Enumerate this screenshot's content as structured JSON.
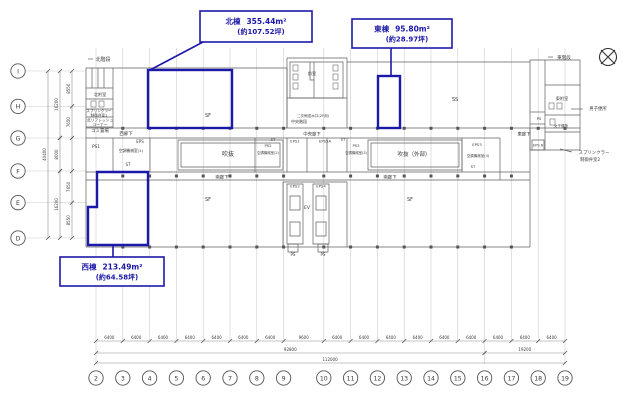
{
  "drawing_type": "architectural-floor-plan",
  "colors": {
    "highlight_blue": "#1c19a8",
    "wall_gray": "#5f5f5f",
    "grid_gray": "#c9c9c9"
  },
  "boxes": {
    "north": {
      "label": "北棟",
      "area": "355.44m²",
      "tsubo": "(約107.52坪)"
    },
    "east": {
      "label": "東棟",
      "area": "95.80m²",
      "tsubo": "(約28.97坪)"
    },
    "west": {
      "label": "西棟",
      "area": "213.49m²",
      "tsubo": "(約64.58坪)"
    }
  },
  "grid": {
    "cols": [
      "2",
      "3",
      "4",
      "5",
      "6",
      "7",
      "8",
      "9",
      "10",
      "11",
      "12",
      "13",
      "14",
      "15",
      "16",
      "17",
      "18",
      "19"
    ],
    "col_dims": [
      "6400",
      "6400",
      "6400",
      "6400",
      "6400",
      "6400",
      "6400",
      "9600",
      "6400",
      "6400",
      "6400",
      "6400",
      "6400",
      "6400",
      "6400",
      "6400",
      "6400"
    ],
    "col_span_dims": [
      {
        "label": "92800",
        "from": 0,
        "to": 14
      },
      {
        "label": "19200",
        "from": 14,
        "to": 17
      }
    ],
    "col_total": "112000",
    "rows": [
      "I",
      "H",
      "G",
      "F",
      "E",
      "D"
    ],
    "row_dims": [
      "8550",
      "7650",
      "8000",
      "7650",
      "8550"
    ],
    "row_span_dims": [
      "16200",
      "8000",
      "16200"
    ],
    "row_total": "40400"
  },
  "rooms": {
    "north_stair": "北階段",
    "north_annex": "北附室",
    "sprinkler1_l1": "スプリンクラー",
    "sprinkler1_l2": "制御弁室1",
    "refresh_l1": "北リフレッシュ",
    "refresh_l2": "コーナー",
    "garbage": "ゴミ置場",
    "ps1": "PS1",
    "eps_w": "EPS",
    "ac1": "空調機械室(1)",
    "st": "ST",
    "void_west": "吹抜",
    "corridor_west": "西廊下",
    "corridor_center": "中央廊下",
    "corridor_east": "東廊下",
    "corridor_south": "南廊下",
    "sf": "SF",
    "anteroom": "前室",
    "water_inlet": "二次側送水口(2F用)",
    "center_stair": "中央階段",
    "eps1": "EPS1",
    "eps5a": "EPS5A",
    "ps2": "PS2",
    "ac2": "空調機械室(2)",
    "ps3": "PS3",
    "ac3": "空調機械室(3)",
    "void_east": "吹抜（外部）",
    "eps3": "EPS3",
    "ac4": "空調機械室(4)",
    "ss": "SS",
    "eps2": "EPS2",
    "eps4": "EPS4",
    "ev": "EV",
    "ps": "PS",
    "east_stair": "東階段",
    "east_annex": "東附室",
    "mens_toilet": "男子便所",
    "womens_toilet": "女子便所",
    "eps6": "EPS 6",
    "sprinkler2_l1": "スプリンクラー",
    "sprinkler2_l2": "制御弁室2"
  }
}
